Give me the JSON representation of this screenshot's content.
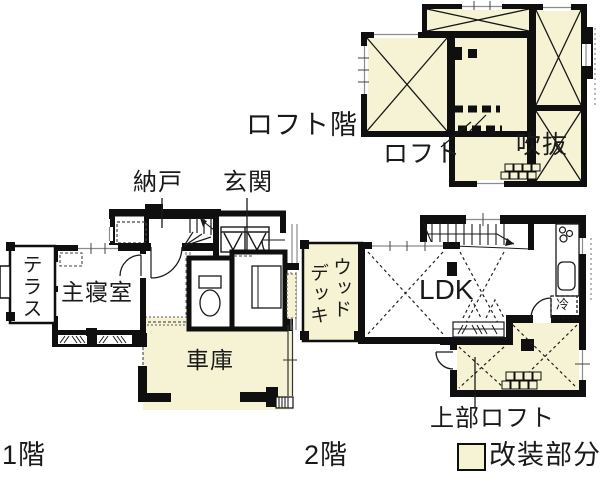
{
  "colors": {
    "renovation_fill": "#f6f3d4",
    "wall": "#0f0f0f"
  },
  "legend": {
    "label": "改装部分"
  },
  "floors": {
    "loft": {
      "title": "ロフト階",
      "rooms": {
        "loft": "ロフト",
        "void": "吹抜"
      }
    },
    "first": {
      "title": "1階",
      "rooms": {
        "storage": "納戸",
        "entrance": "玄関",
        "terrace": "テラス",
        "master_bedroom": "主寝室",
        "garage": "車庫"
      }
    },
    "second": {
      "title": "2階",
      "rooms": {
        "wood_deck_line1": "ウッド",
        "wood_deck_line2": "デッキ",
        "ldk": "LDK",
        "refrigerator": "冷",
        "upper_loft": "上部ロフト"
      }
    }
  }
}
